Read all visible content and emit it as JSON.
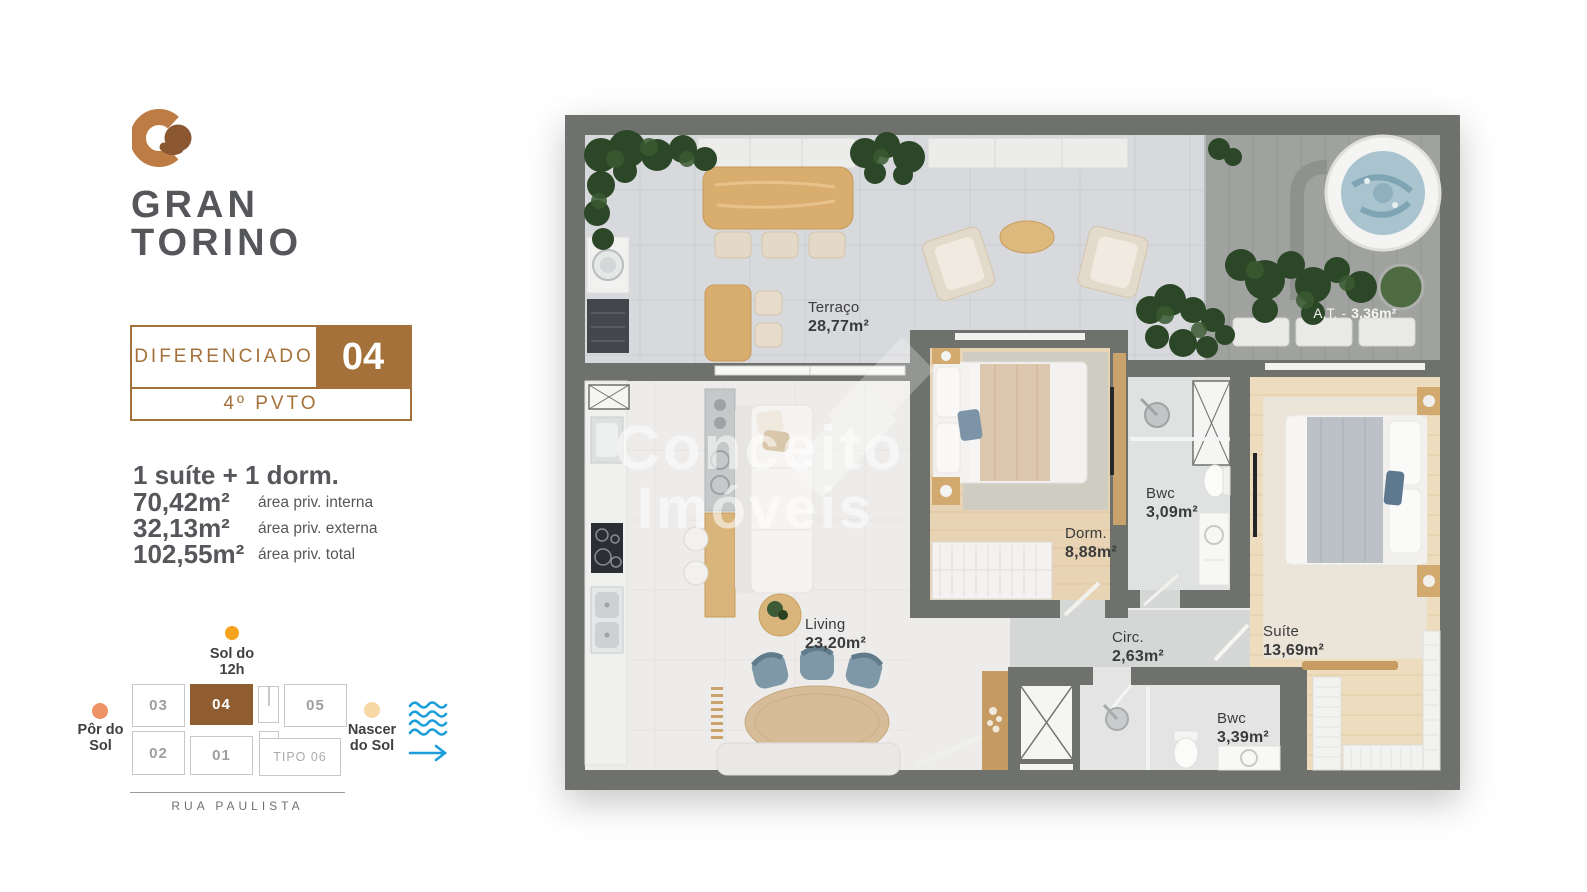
{
  "brand": {
    "name_line1": "GRAN",
    "name_line2": "TORINO"
  },
  "unit_badge": {
    "type_label": "DIFERENCIADO",
    "unit_number": "04",
    "floor_label": "4º PVTO"
  },
  "summary": {
    "headline": "1 suíte + 1 dorm.",
    "areas": [
      {
        "value": "70,42m²",
        "label": "área priv. interna"
      },
      {
        "value": "32,13m²",
        "label": "área priv. externa"
      },
      {
        "value": "102,55m²",
        "label": "área priv. total"
      }
    ]
  },
  "site_plan": {
    "sun_noon_line1": "Sol do",
    "sun_noon_line2": "12h",
    "sun_set_line1": "Pôr do",
    "sun_set_line2": "Sol",
    "sun_rise_line1": "Nascer",
    "sun_rise_line2": "do Sol",
    "street": "RUA PAULISTA",
    "units": [
      "03",
      "04",
      "05",
      "02",
      "01",
      "TIPO 06"
    ]
  },
  "floor_plan": {
    "watermark_line1": "Conceito",
    "watermark_line2": "Imóveis",
    "rooms": [
      {
        "name": "Terraço",
        "area": "28,77m²"
      },
      {
        "name": "A.T. -",
        "area": "3,36m²"
      },
      {
        "name": "Dorm.",
        "area": "8,88m²"
      },
      {
        "name": "Bwc",
        "area": "3,09m²"
      },
      {
        "name": "Living",
        "area": "23,20m²"
      },
      {
        "name": "Circ.",
        "area": "2,63m²"
      },
      {
        "name": "Suíte",
        "area": "13,69m²"
      },
      {
        "name": "Bwc",
        "area": "3,39m²"
      }
    ]
  },
  "colors": {
    "brand_brown": "#A5713A",
    "highlight_unit_brown": "#8F5D30",
    "wave_blue": "#1B9ED9",
    "sun_noon": "#F5A31C",
    "sun_set": "#EE9368",
    "sun_rise": "#F6D8A4"
  }
}
